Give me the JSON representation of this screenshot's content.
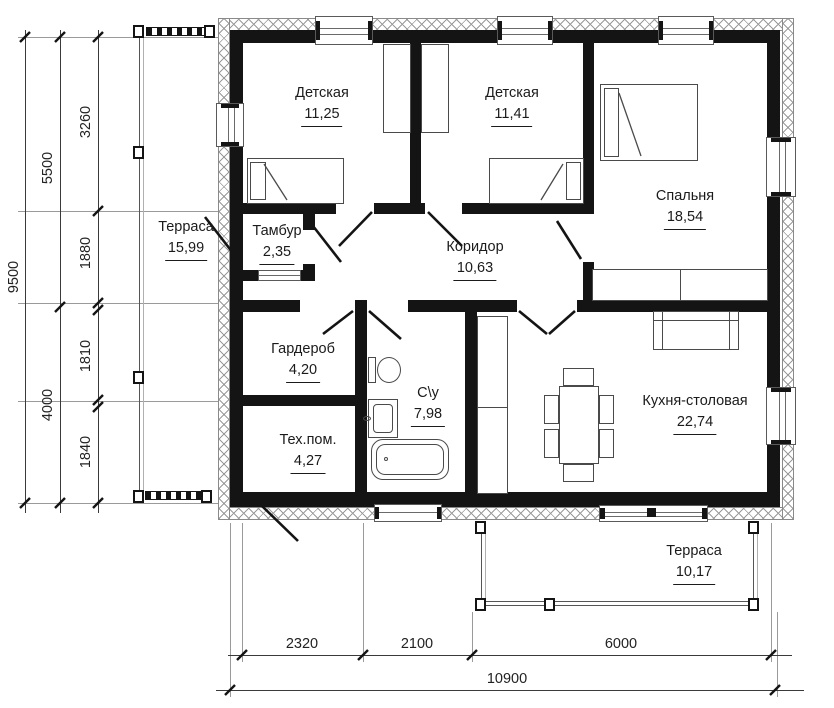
{
  "rooms": [
    {
      "name": "Детская",
      "area": "11,25"
    },
    {
      "name": "Детская",
      "area": "11,41"
    },
    {
      "name": "Спальня",
      "area": "18,54"
    },
    {
      "name": "Терраса",
      "area": "15,99"
    },
    {
      "name": "Тамбур",
      "area": "2,35"
    },
    {
      "name": "Коридор",
      "area": "10,63"
    },
    {
      "name": "Гардероб",
      "area": "4,20"
    },
    {
      "name": "Тех.пом.",
      "area": "4,27"
    },
    {
      "name": "С\\у",
      "area": "7,98"
    },
    {
      "name": "Кухня-столовая",
      "area": "22,74"
    },
    {
      "name": "Терраса",
      "area": "10,17"
    }
  ],
  "dimensions": {
    "left_outer": "9500",
    "left_mid": [
      "5500",
      "4000"
    ],
    "left_inner": [
      "3260",
      "1880",
      "1810",
      "1840"
    ],
    "bottom_inner": [
      "2320",
      "2100",
      "6000"
    ],
    "bottom_outer": "10900"
  },
  "drawing_colors": {
    "walls": "#141414",
    "furniture": "#4a4a4a",
    "dims": "#222222"
  }
}
